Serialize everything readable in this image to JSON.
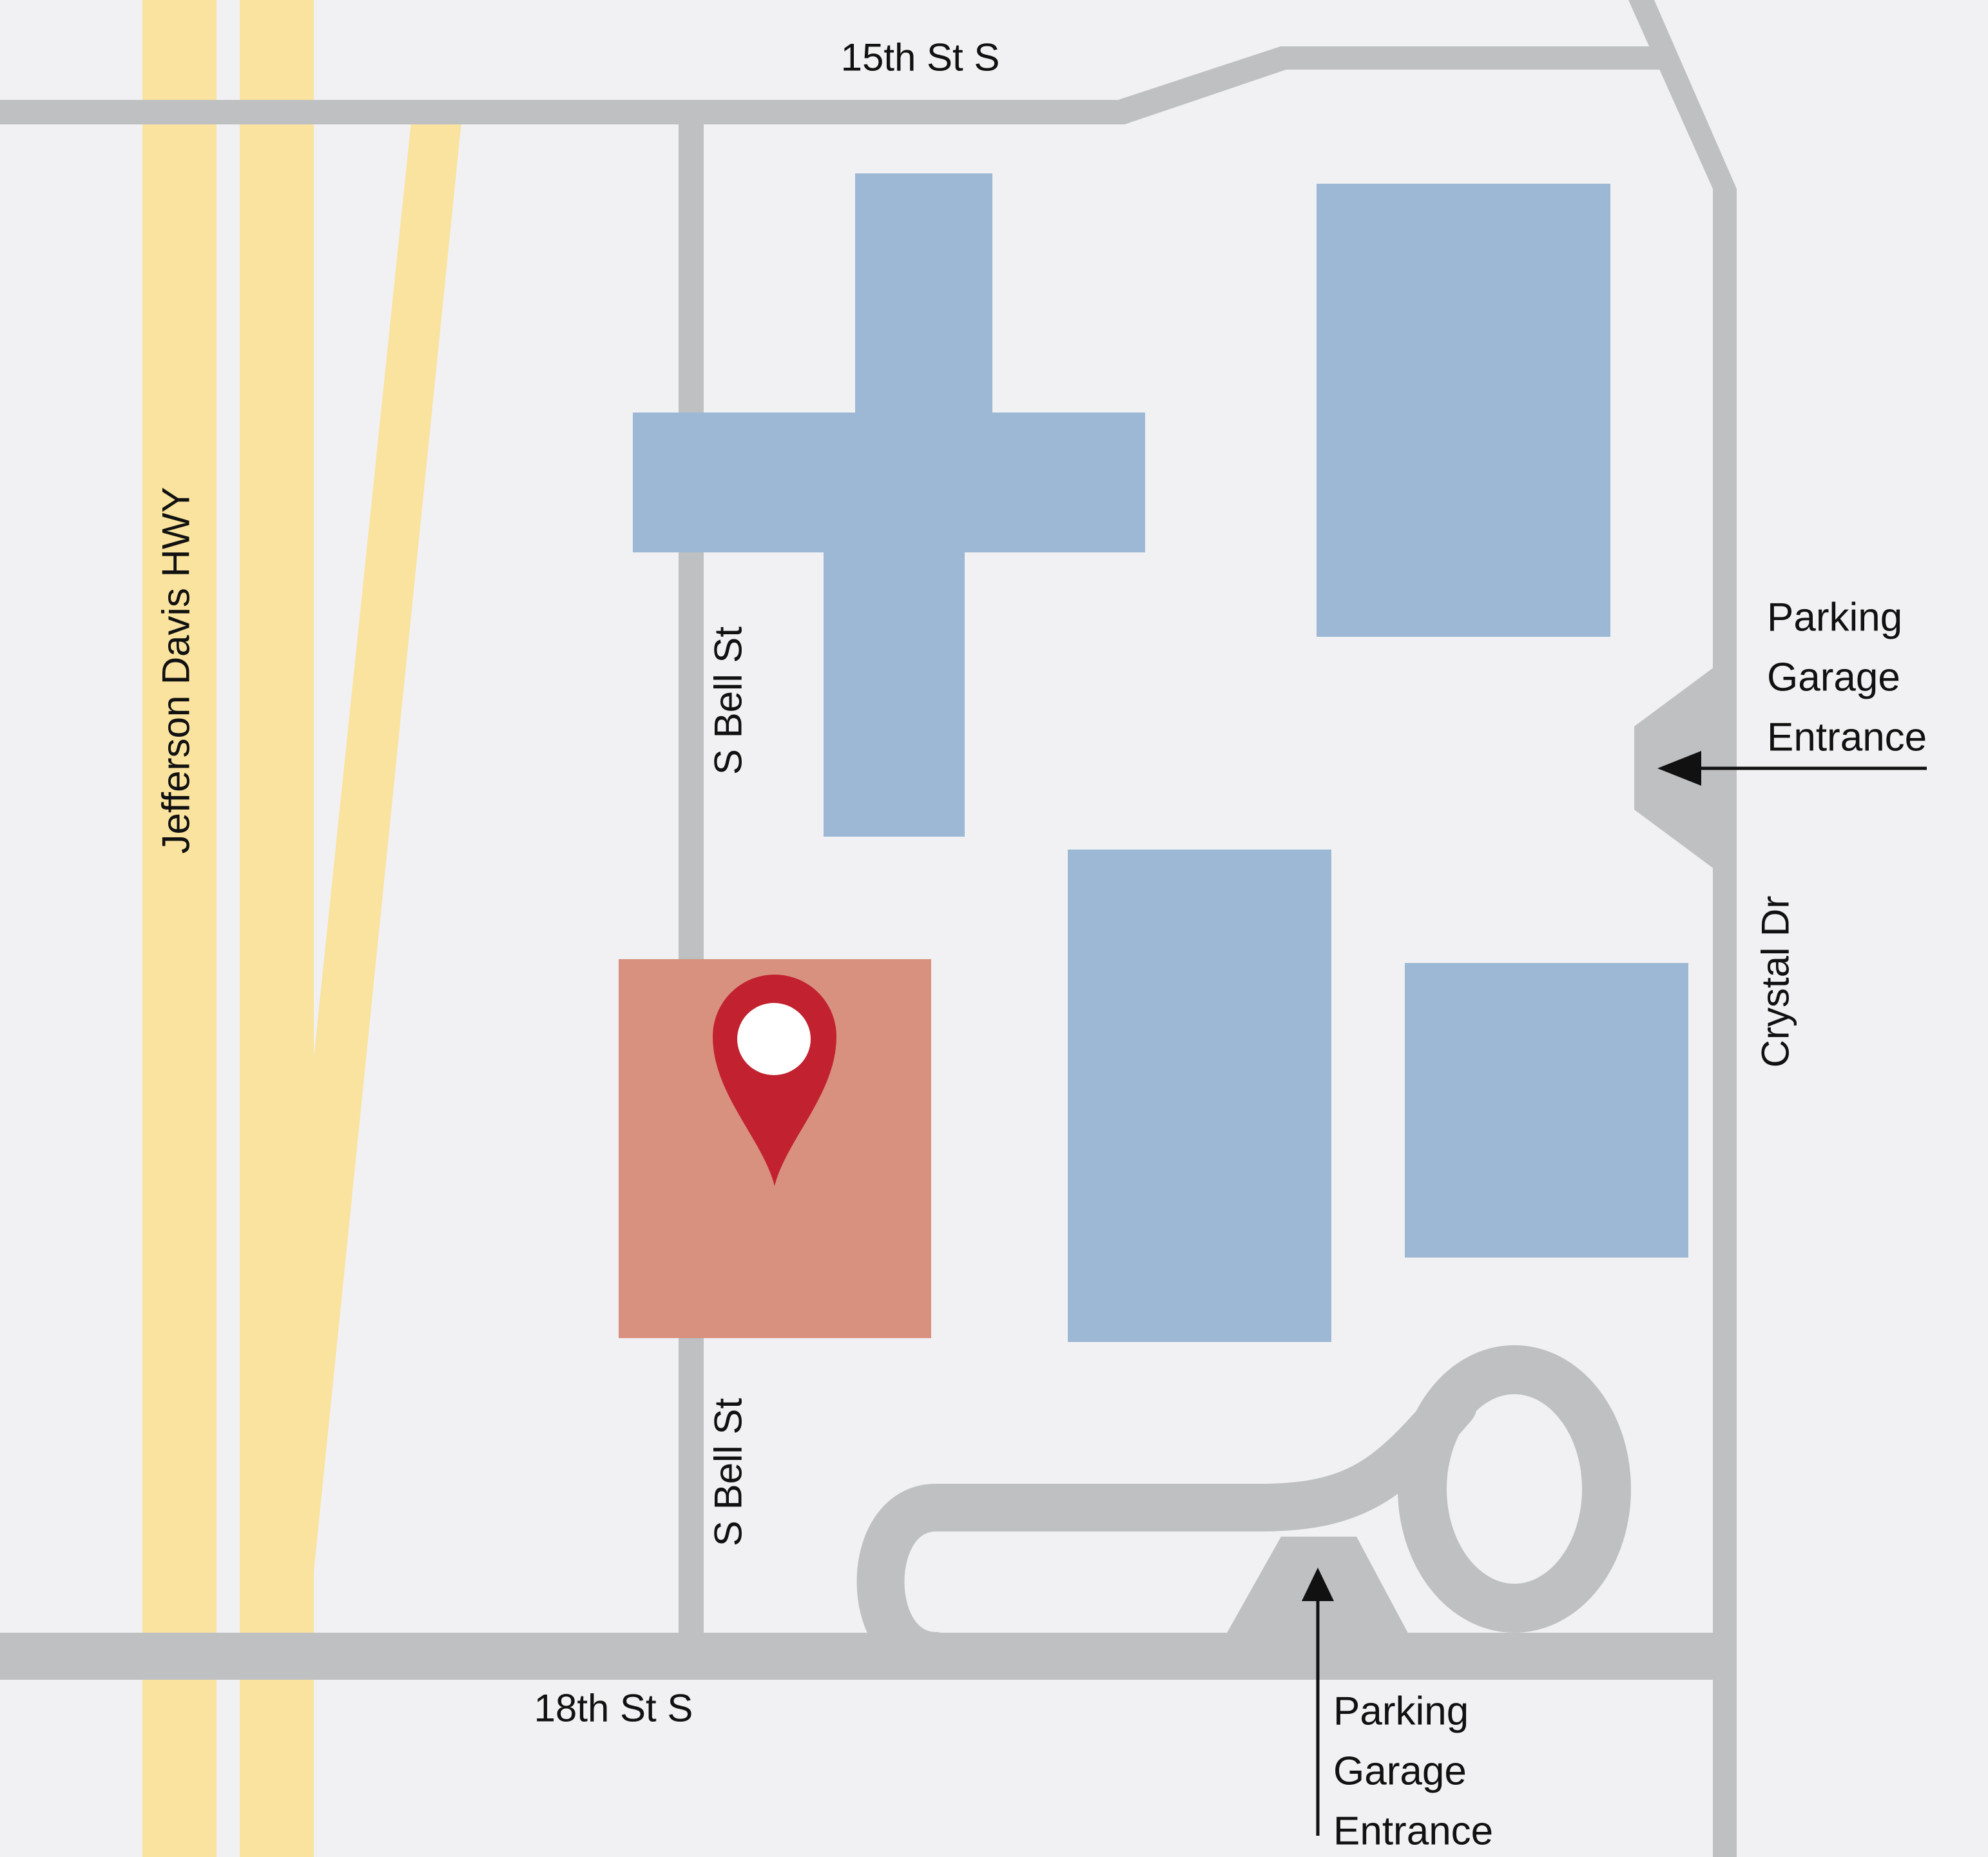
{
  "map": {
    "kind": "simplified street locator map"
  },
  "streets": {
    "street_15th": "15th St S",
    "street_18th": "18th St S",
    "jefferson_davis": "Jefferson Davis HWY",
    "s_bell_upper": "S Bell St",
    "s_bell_lower": "S Bell St",
    "crystal_dr": "Crystal Dr"
  },
  "annotations": {
    "parking_right": [
      "Parking",
      "Garage",
      "Entrance"
    ],
    "parking_bottom": [
      "Parking",
      "Garage",
      "Entrance"
    ]
  },
  "colors": {
    "background": "#F1F1F3",
    "highway": "#FAE39E",
    "road": "#BEC0C2",
    "building": "#9CB8D5",
    "destination": "#D9917F",
    "pin": "#C2222F",
    "pin_center": "#FFFFFF",
    "text": "#111111"
  }
}
